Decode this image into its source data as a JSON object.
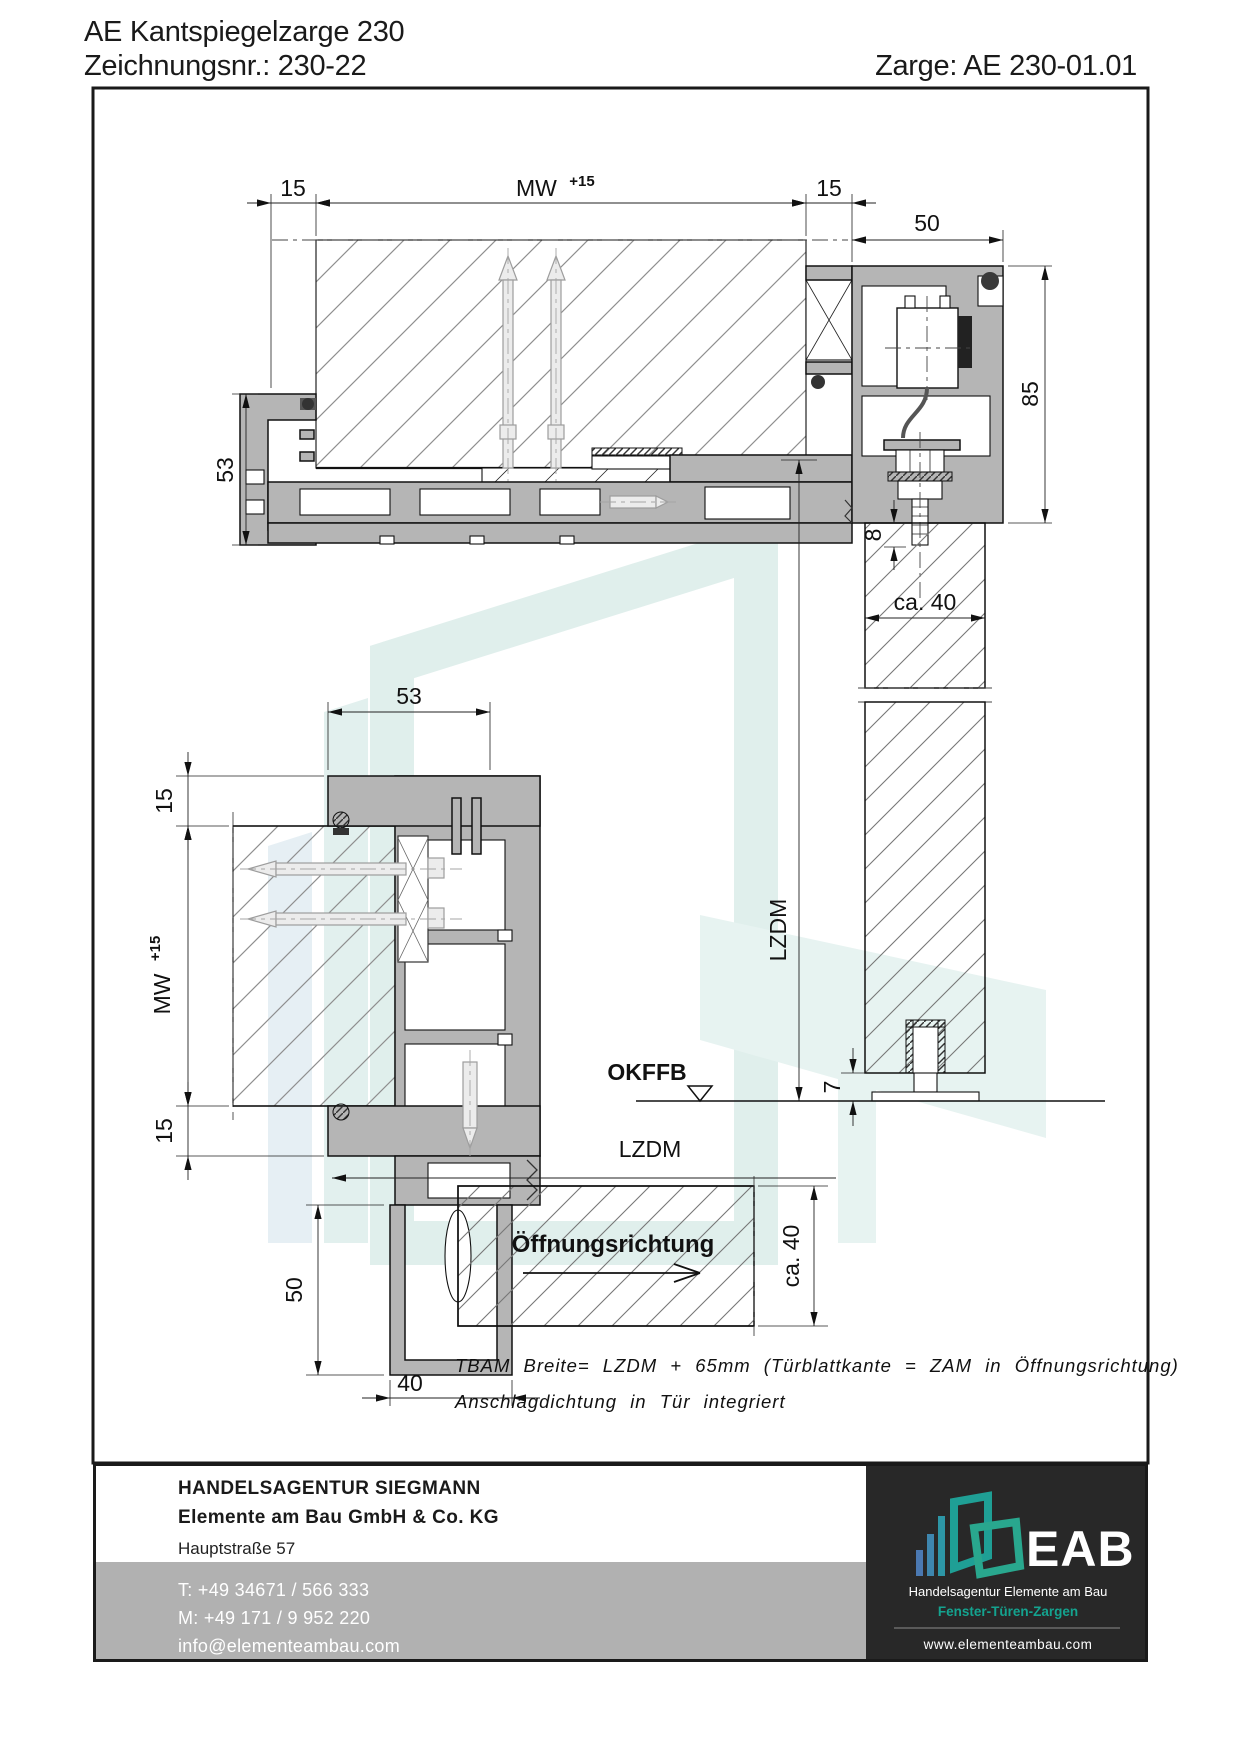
{
  "header": {
    "title": "AE Kantspiegelzarge 230",
    "drawing_no": "Zeichnungsnr.: 230-22",
    "zarge_ref": "Zarge: AE 230-01.01"
  },
  "drawing": {
    "top_section": {
      "dim_15_left": "15",
      "dim_mw": "MW",
      "dim_mw_sup": "+15",
      "dim_15_right": "15",
      "dim_50": "50",
      "dim_85": "85",
      "dim_53": "53",
      "dim_8": "8",
      "dim_ca40": "ca. 40",
      "dim_7": "7",
      "label_lzdm": "LZDM",
      "label_okffb": "OKFFB"
    },
    "side_section": {
      "dim_53": "53",
      "dim_15_top": "15",
      "dim_mw": "MW",
      "dim_mw_sup": "+15",
      "dim_15_bottom": "15",
      "dim_50": "50",
      "dim_40": "40",
      "dim_ca40": "ca. 40",
      "label_lzdm": "LZDM",
      "label_opening_direction": "Öffnungsrichtung"
    },
    "notes": {
      "line1": "TBAM Breite= LZDM + 65mm (Türblattkante = ZAM in Öffnungsrichtung)",
      "line2": "Anschlagdichtung in Tür integriert"
    }
  },
  "footer": {
    "company_line1": "HANDELSAGENTUR SIEGMANN",
    "company_line2": "Elemente am Bau GmbH & Co. KG",
    "address_line1": "Hauptstraße 57",
    "address_line2": "06567 Bad Frankenhausen / OT Udersleben",
    "phone": "T: +49 34671 / 566 333",
    "mobile": "M: +49 171 / 9 952 220",
    "email": "info@elementeambau.com"
  },
  "logo": {
    "acronym": "EAB",
    "subtitle": "Handelsagentur Elemente am Bau",
    "tagline": "Fenster-Türen-Zargen",
    "website": "www.elementeambau.com"
  },
  "colors": {
    "aluminum": "#b5b5b5",
    "panel_dark": "#282828",
    "footer_gray": "#b1b1b1",
    "accent_teal": "#14a38f",
    "logo_blue": "#4b79b2",
    "logo_teal": "#1f9f95",
    "watermark": "#e0efec"
  }
}
